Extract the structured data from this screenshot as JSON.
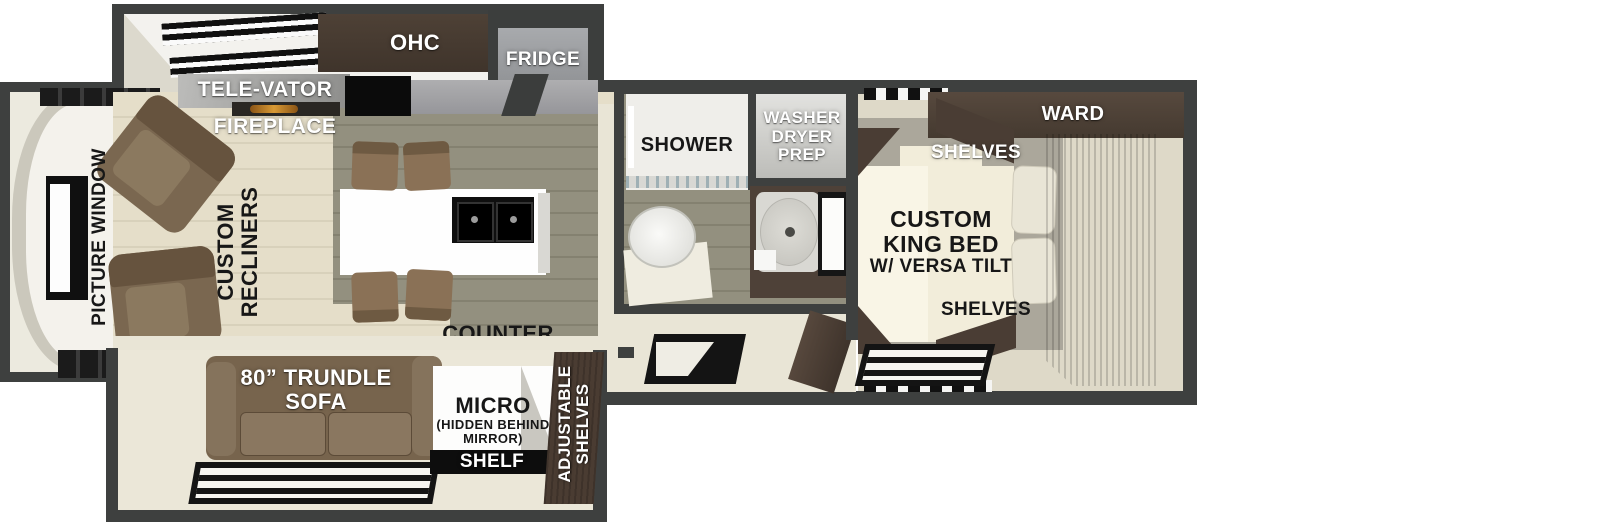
{
  "diagram_type": "rv-travel-trailer-floorplan",
  "labels": {
    "ohc": "OHC",
    "fridge": "FRIDGE",
    "televator": "TELE-VATOR",
    "fireplace": "FIREPLACE",
    "picture_window": "PICTURE WINDOW",
    "recliners": [
      "CUSTOM",
      "RECLINERS"
    ],
    "counter_top": [
      "COUNTER",
      "TOP"
    ],
    "shower": "SHOWER",
    "washer_dryer_prep": [
      "WASHER",
      "DRYER",
      "PREP"
    ],
    "ward": "WARD",
    "shelves_top": "SHELVES",
    "king_bed": [
      "CUSTOM",
      "KING BED",
      "W/ VERSA TILT"
    ],
    "shelves_bottom": "SHELVES",
    "trundle_sofa": [
      "80” TRUNDLE",
      "SOFA"
    ],
    "micro": [
      "MICRO",
      "(HIDDEN BEHIND",
      "MIRROR)"
    ],
    "shelf": "SHELF",
    "adjustable_shelves": [
      "ADJUSTABLE",
      "SHELVES"
    ]
  },
  "colors": {
    "wall": "#3e403f",
    "floor_beige": "#e5dec9",
    "floor_olive": "#93907f",
    "floor_cream": "#e9e5d6",
    "cabinet_brown": "#4a3d33",
    "ward_wood": "#57493e",
    "sofa_brown": "#77644d",
    "recliner_brown": "#7a6750",
    "chair_brown": "#8a7156",
    "island_white": "#fefefe",
    "sink_black": "#0f0f0f",
    "counter_gray": "#a4a4a6",
    "fridge_gray": "#9c9ea1",
    "fireplace_glow": "#d99a35",
    "bed_cream": "#f2edda",
    "bedroom_gray": "#aba79b"
  }
}
